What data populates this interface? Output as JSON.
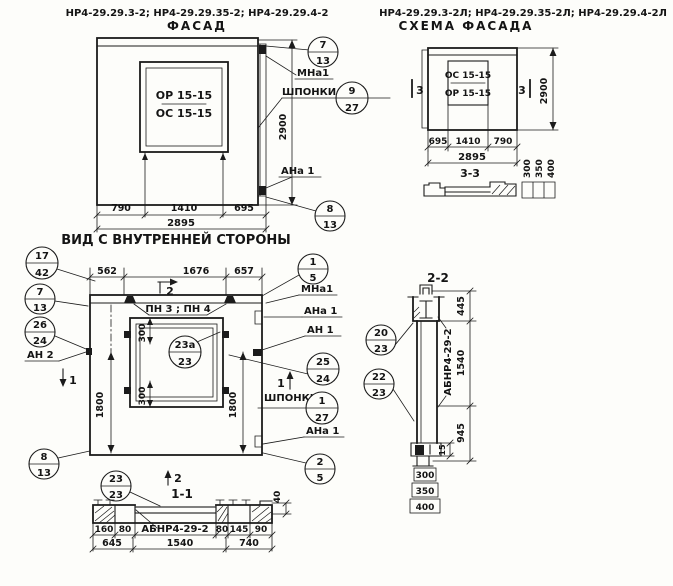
{
  "colors": {
    "ink": "#1b1b1b",
    "paper": "#fdfdfa"
  },
  "facade": {
    "codes": "НР4-29.29.3-2; НР4-29.29.35-2; НР4-29.29.4-2",
    "title": "ФАСАД",
    "window_mark_top": "ОР 15-15",
    "window_mark_bottom": "ОС 15-15",
    "dim_left": "790",
    "dim_mid": "1410",
    "dim_right": "695",
    "dim_total": "2895",
    "dim_height": "2900",
    "label_mna": "МНа1",
    "label_shponki": "ШПОНКИ",
    "label_ana": "АНа 1",
    "bubble_top": {
      "pos": "7",
      "sheet": "13"
    },
    "bubble_key": {
      "pos": "9",
      "sheet": "27"
    },
    "bubble_bottom": {
      "pos": "8",
      "sheet": "13"
    }
  },
  "schema": {
    "codes": "НР4-29.29.3-2Л; НР4-29.29.35-2Л; НР4-29.29.4-2Л",
    "title": "СХЕМА ФАСАДА",
    "window_mark_top": "ОС 15-15",
    "window_mark_bottom": "ОР 15-15",
    "section_marker": "3",
    "dim_left": "695",
    "dim_mid": "1410",
    "dim_right": "790",
    "dim_total": "2895",
    "dim_height": "2900",
    "section_title": "3-3",
    "thickness_1": "300",
    "thickness_2": "350",
    "thickness_3": "400"
  },
  "interior": {
    "title": "ВИД С ВНУТРЕННЕЙ СТОРОНЫ",
    "dim_top_left": "562",
    "dim_top_mid": "1676",
    "dim_top_right": "657",
    "marker_2": "2",
    "marker_1": "1",
    "label_pn": "ПН 3 ; ПН 4",
    "label_an2": "АН 2",
    "label_mna": "МНа1",
    "label_ana": "АНа 1",
    "label_an1": "АН 1",
    "label_shponki": "ШПОНКИ",
    "label_ana2": "АНа 1",
    "dim_win_top": "300",
    "dim_win_bottom": "300",
    "dim_side_left": "1800",
    "dim_side_right": "1800",
    "b_17_42": {
      "pos": "17",
      "sheet": "42"
    },
    "b_7_13": {
      "pos": "7",
      "sheet": "13"
    },
    "b_26_24": {
      "pos": "26",
      "sheet": "24"
    },
    "b_8_13": {
      "pos": "8",
      "sheet": "13"
    },
    "b_1_5": {
      "pos": "1",
      "sheet": "5"
    },
    "b_25_24": {
      "pos": "25",
      "sheet": "24"
    },
    "b_1_27": {
      "pos": "1",
      "sheet": "27"
    },
    "b_2_5": {
      "pos": "2",
      "sheet": "5"
    },
    "b_23a": {
      "pos": "23а",
      "sheet": "23"
    }
  },
  "section11": {
    "title": "1-1",
    "marker": "2",
    "b_23": {
      "pos": "23",
      "sheet": "23"
    },
    "beam_label": "АБНР4-29-2",
    "d160": "160",
    "d80a": "80",
    "d80b": "80",
    "d145": "145",
    "d90": "90",
    "d645": "645",
    "d1540": "1540",
    "d740": "740",
    "d40": "40"
  },
  "section22": {
    "title": "2-2",
    "b_20": {
      "pos": "20",
      "sheet": "23"
    },
    "b_22": {
      "pos": "22",
      "sheet": "23"
    },
    "beam_label": "АБНР4-29-2",
    "d445": "445",
    "d1540": "1540",
    "d945": "945",
    "d15": "15",
    "d300": "300",
    "d350": "350",
    "d400": "400"
  }
}
